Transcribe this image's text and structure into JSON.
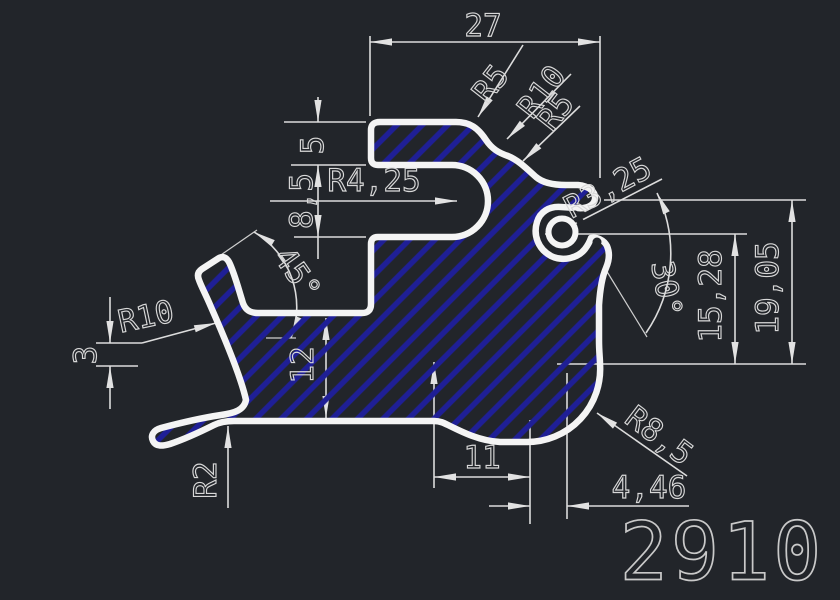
{
  "drawing": {
    "part_number": "2910",
    "colors": {
      "background": "#22252a",
      "outline": "#f4f4f4",
      "hatch": "#1f1f96",
      "dimension_lines": "#dcdcdc",
      "dimension_text": "#d8d8d8"
    },
    "labels": {
      "width_top": "27",
      "radius_top_1": "R5",
      "radius_top_2": "R10",
      "radius_top_3": "R5",
      "flange_thickness": "5",
      "notch_height": "8,5",
      "notch_radius": "R4,25",
      "hook_radius": "R3,25",
      "hook_angle": "30°",
      "height_inner": "15,28",
      "height_outer": "19,05",
      "arm_angle": "45°",
      "arm_radius": "R10",
      "lip_offset": "3",
      "body_height": "12",
      "lip_radius": "R2",
      "bottom_width": "11",
      "corner_offset": "4,46",
      "corner_radius": "R8,5"
    }
  }
}
